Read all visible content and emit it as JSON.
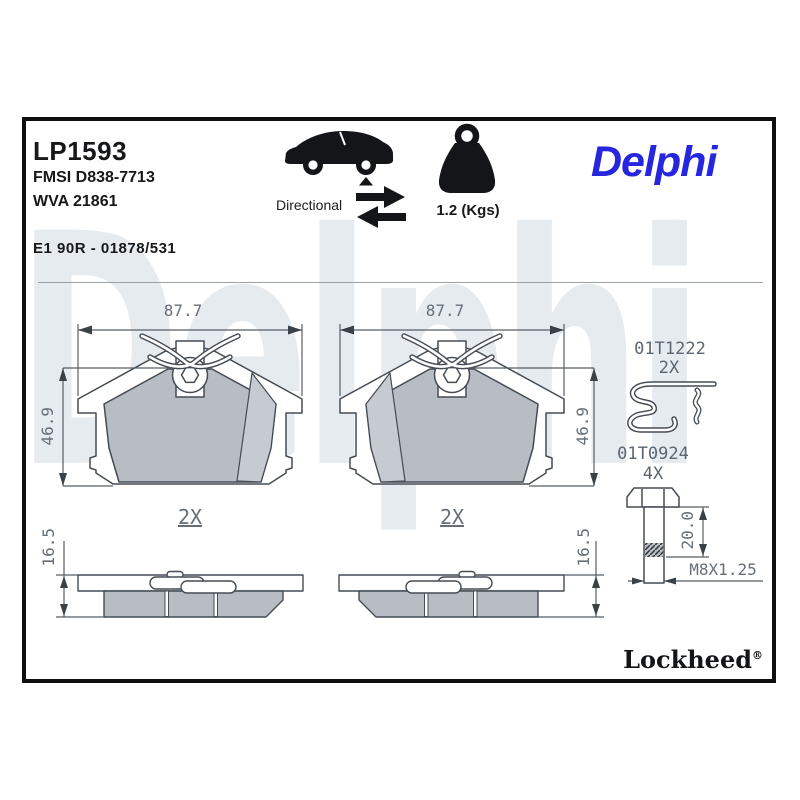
{
  "header": {
    "part_number": "LP1593",
    "fmsi_code": "FMSI D838-7713",
    "wva_code": "WVA 21861",
    "approval_code": "E1 90R - 01878/531",
    "directional_label": "Directional",
    "weight_value": "1.2 (Kgs)",
    "brand_logo": "Delphi"
  },
  "icons": {
    "vehicle": "car-rear-axle-icon",
    "directional": "directional-arrows-icon",
    "weight": "weight-kettlebell-icon"
  },
  "drawing": {
    "watermark_text": "Delphi",
    "front_views": [
      {
        "width_mm": "87.7",
        "height_mm": "46.9",
        "quantity": "2X"
      },
      {
        "width_mm": "87.7",
        "height_mm": "46.9",
        "quantity": "2X"
      }
    ],
    "side_views": [
      {
        "thickness_mm": "16.5"
      },
      {
        "thickness_mm": "16.5"
      }
    ],
    "accessories": [
      {
        "part_number": "01T1222",
        "quantity": "2X",
        "type": "spring-clip"
      },
      {
        "part_number": "01T0924",
        "quantity": "4X",
        "type": "guide-bolt",
        "length_mm": "20.0",
        "thread_spec": "M8X1.25"
      }
    ]
  },
  "footer": {
    "brand": "Lockheed",
    "registered_mark": "®"
  },
  "colors": {
    "brand_blue": "#2526dd",
    "watermark": "#e6ebf0",
    "friction_gray": "#b7bdc3",
    "line_dark": "#454c54",
    "dim_text": "#666f78"
  }
}
